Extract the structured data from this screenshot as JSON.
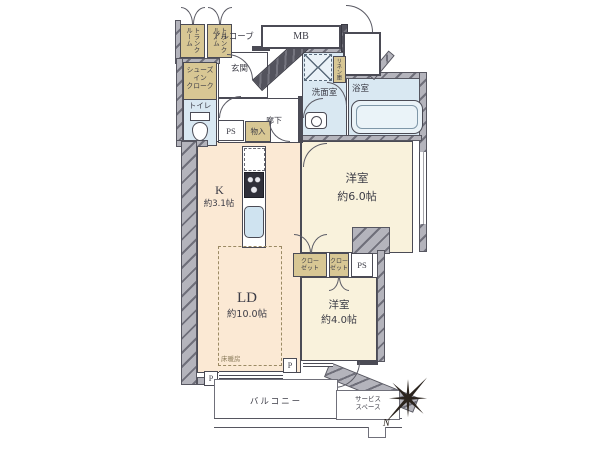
{
  "floorplan": {
    "labels": {
      "trunk_room": "トランクルーム",
      "alcove": "アルコーブ",
      "meter_box": "MB",
      "shoes_cloak_1": "シューズ",
      "shoes_cloak_2": "イン",
      "shoes_cloak_3": "クローク",
      "entrance": "玄関",
      "toilet": "トイレ",
      "pipe_space": "PS",
      "storage": "物入",
      "corridor": "廊下",
      "washroom": "洗面室",
      "linen": "リネン庫",
      "bathroom": "浴室",
      "kitchen_name": "K",
      "kitchen_size": "約3.1帖",
      "west_room6_name": "洋室",
      "west_room6_size": "約6.0帖",
      "closet_line1": "クロー",
      "closet_line2": "ゼット",
      "living_name": "LD",
      "living_size": "約10.0帖",
      "floor_heating": "床暖房",
      "west_room4_name": "洋室",
      "west_room4_size": "約4.0帖",
      "pillar": "P",
      "balcony": "バルコニー",
      "service_1": "サービス",
      "service_2": "スペース",
      "north": "N"
    },
    "colors": {
      "room_cream": "#fbe9d4",
      "room_pale_yellow": "#f9f2dc",
      "wet_area_blue": "#d9e8f2",
      "storage_tan": "#d8c794",
      "wall_gray": "#b4b4bc",
      "wall_dark": "#53535d",
      "line": "#4b4b55"
    }
  }
}
